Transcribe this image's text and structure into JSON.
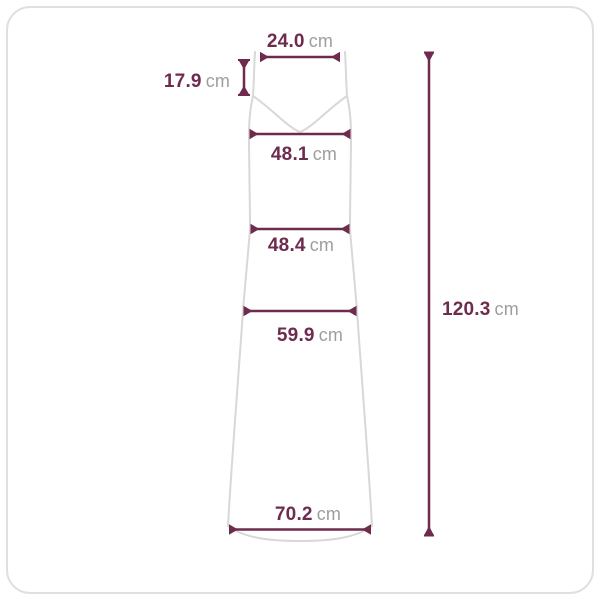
{
  "colors": {
    "dimension_line": "#6e2b4d",
    "value_text": "#6e2b4d",
    "unit_text": "#9e9e9e",
    "garment_outline": "#d8d8d8",
    "card_border": "#e0e0e0",
    "background": "#ffffff"
  },
  "measurements": {
    "top_width": {
      "value": "24.0",
      "unit": "cm"
    },
    "strap_drop": {
      "value": "17.9",
      "unit": "cm"
    },
    "bust_width": {
      "value": "48.1",
      "unit": "cm"
    },
    "waist_width": {
      "value": "48.4",
      "unit": "cm"
    },
    "hip_width": {
      "value": "59.9",
      "unit": "cm"
    },
    "hem_width": {
      "value": "70.2",
      "unit": "cm"
    },
    "total_length": {
      "value": "120.3",
      "unit": "cm"
    }
  }
}
